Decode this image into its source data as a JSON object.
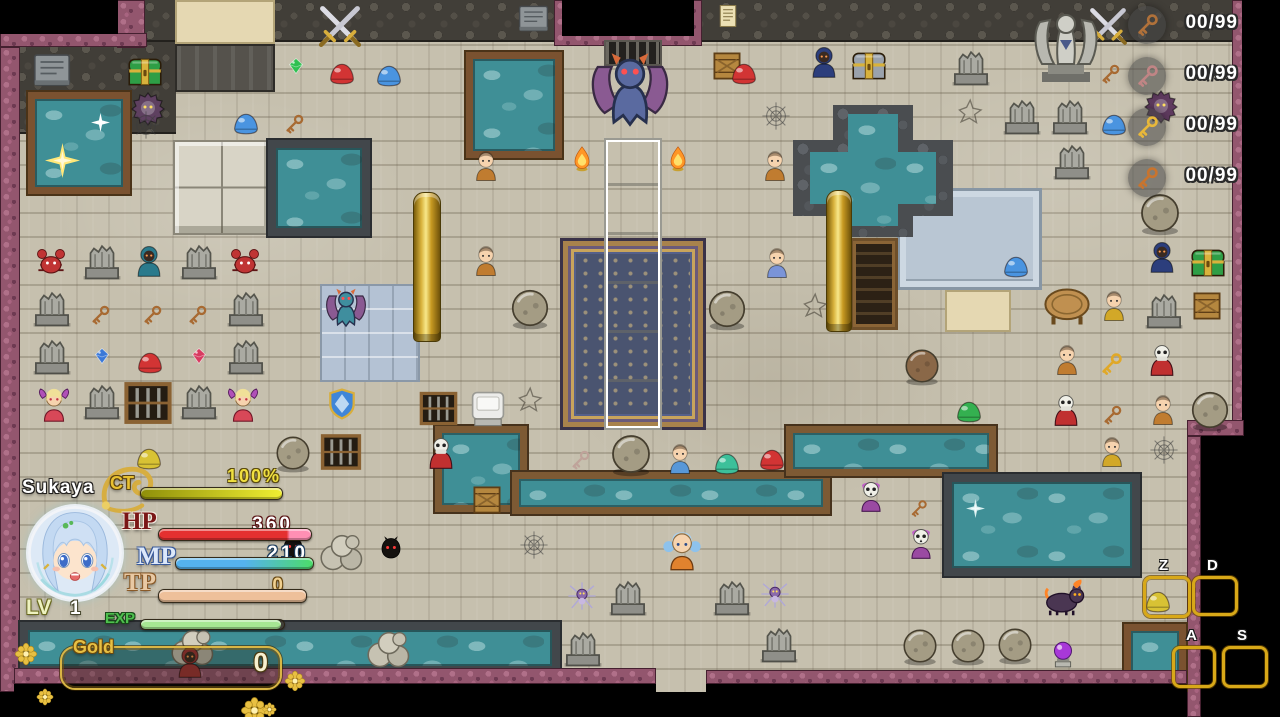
{
  "hud": {
    "name": "Sukaya",
    "ct": {
      "label": "CT",
      "value": "100%",
      "pct": 100,
      "bar_colors": [
        "#8f8f0a",
        "#f0ee32"
      ]
    },
    "hp": {
      "label": "HP",
      "value": "360",
      "pct": 100,
      "bar_color": "#e43030",
      "tip_color": "#ff8fb4"
    },
    "mp": {
      "label": "MP",
      "value": "210",
      "pct": 100,
      "bar_colors": [
        "#55b2ee",
        "#55b2ee",
        "#4cdc6a"
      ]
    },
    "tp": {
      "label": "TP",
      "value": "0",
      "pct": 100,
      "bar_color": "#eec09a"
    },
    "lv": {
      "label": "LV",
      "value": "1"
    },
    "exp": {
      "label": "EXP",
      "pct": 98,
      "bar_color": "#a6e693"
    },
    "gold": {
      "label": "Gold",
      "value": "0"
    },
    "accent_gold": "#d9b544",
    "decor_flowers": [
      {
        "x": 14,
        "y": 642,
        "s": 1.1
      },
      {
        "x": 36,
        "y": 688,
        "s": 0.8
      },
      {
        "x": 284,
        "y": 670,
        "s": 1.0
      },
      {
        "x": 240,
        "y": 696,
        "s": 1.3
      },
      {
        "x": 262,
        "y": 702,
        "s": 0.7
      }
    ]
  },
  "key_counters": [
    {
      "name": "bronze-key",
      "count": "00/99",
      "color": "#b0713a"
    },
    {
      "name": "rose-key",
      "count": "00/99",
      "color": "#c08585"
    },
    {
      "name": "gold-key",
      "count": "00/99",
      "color": "#e8b83a"
    },
    {
      "name": "ornate-key",
      "count": "00/99",
      "color": "#c8742e"
    }
  ],
  "hotkeys": [
    {
      "label": "Z",
      "x": 1143,
      "y": 576,
      "w": 42,
      "h": 36
    },
    {
      "label": "D",
      "x": 1192,
      "y": 576,
      "w": 40,
      "h": 34
    },
    {
      "label": "A",
      "x": 1172,
      "y": 646,
      "w": 38,
      "h": 36
    },
    {
      "label": "S",
      "x": 1222,
      "y": 646,
      "w": 40,
      "h": 36
    }
  ],
  "scene": {
    "regions": [
      {
        "t": "cobble",
        "x": 14,
        "y": 0,
        "w": 1220,
        "h": 42
      },
      {
        "t": "cobble",
        "x": 14,
        "y": 42,
        "w": 162,
        "h": 92
      },
      {
        "t": "tan",
        "x": 175,
        "y": 0,
        "w": 100,
        "h": 44
      },
      {
        "t": "plat",
        "x": 175,
        "y": 44,
        "w": 100,
        "h": 48
      },
      {
        "t": "purple",
        "x": 117,
        "y": 0,
        "w": 28,
        "h": 48
      },
      {
        "t": "purple",
        "x": 0,
        "y": 33,
        "w": 147,
        "h": 14
      },
      {
        "t": "void",
        "x": 0,
        "y": 0,
        "w": 118,
        "h": 34
      },
      {
        "t": "purple",
        "x": 0,
        "y": 47,
        "w": 20,
        "h": 645
      },
      {
        "t": "purple",
        "x": 554,
        "y": 0,
        "w": 148,
        "h": 46
      },
      {
        "t": "void",
        "x": 562,
        "y": 0,
        "w": 132,
        "h": 36
      },
      {
        "t": "vent",
        "x": 604,
        "y": 40,
        "w": 58,
        "h": 26
      },
      {
        "t": "purple",
        "x": 1232,
        "y": 0,
        "w": 12,
        "h": 434
      },
      {
        "t": "void",
        "x": 1242,
        "y": 0,
        "w": 38,
        "h": 717
      },
      {
        "t": "purple",
        "x": 1187,
        "y": 420,
        "w": 57,
        "h": 16
      },
      {
        "t": "purple",
        "x": 1187,
        "y": 436,
        "w": 14,
        "h": 281
      },
      {
        "t": "void",
        "x": 1201,
        "y": 436,
        "w": 41,
        "h": 281
      },
      {
        "t": "tiles",
        "x": 320,
        "y": 284,
        "w": 100,
        "h": 98
      },
      {
        "t": "blocks",
        "x": 173,
        "y": 140,
        "w": 98,
        "h": 95
      },
      {
        "t": "plat2",
        "x": 897,
        "y": 188,
        "w": 145,
        "h": 102
      },
      {
        "t": "tan",
        "x": 945,
        "y": 290,
        "w": 66,
        "h": 42
      },
      {
        "t": "cab",
        "x": 850,
        "y": 238,
        "w": 48,
        "h": 92
      },
      {
        "t": "poolframe",
        "x": 28,
        "y": 92,
        "w": 102,
        "h": 102
      },
      {
        "t": "pooldark",
        "x": 268,
        "y": 140,
        "w": 102,
        "h": 96
      },
      {
        "t": "poolframe",
        "x": 466,
        "y": 52,
        "w": 96,
        "h": 106
      },
      {
        "t": "rocks",
        "x": 833,
        "y": 105,
        "w": 80,
        "h": 132
      },
      {
        "t": "rocks",
        "x": 793,
        "y": 140,
        "w": 160,
        "h": 76
      },
      {
        "t": "water",
        "x": 848,
        "y": 114,
        "w": 50,
        "h": 112
      },
      {
        "t": "water",
        "x": 810,
        "y": 152,
        "w": 126,
        "h": 52
      },
      {
        "t": "pooldark",
        "x": 20,
        "y": 622,
        "w": 540,
        "h": 52
      },
      {
        "t": "canal",
        "x": 435,
        "y": 426,
        "w": 92,
        "h": 86
      },
      {
        "t": "canal",
        "x": 512,
        "y": 472,
        "w": 318,
        "h": 42
      },
      {
        "t": "canal",
        "x": 786,
        "y": 426,
        "w": 210,
        "h": 50
      },
      {
        "t": "pooldark",
        "x": 944,
        "y": 474,
        "w": 196,
        "h": 102
      },
      {
        "t": "poolframe",
        "x": 1124,
        "y": 624,
        "w": 62,
        "h": 66
      },
      {
        "t": "carpet",
        "x": 560,
        "y": 238,
        "w": 146,
        "h": 192
      },
      {
        "t": "altar",
        "x": 604,
        "y": 138,
        "w": 58,
        "h": 292
      },
      {
        "t": "gold",
        "x": 413,
        "y": 192,
        "w": 28,
        "h": 150
      },
      {
        "t": "gold",
        "x": 826,
        "y": 190,
        "w": 26,
        "h": 142
      },
      {
        "t": "purple",
        "x": 14,
        "y": 668,
        "w": 642,
        "h": 16
      },
      {
        "t": "void",
        "x": 14,
        "y": 684,
        "w": 642,
        "h": 33
      },
      {
        "t": "purple",
        "x": 706,
        "y": 670,
        "w": 481,
        "h": 14
      },
      {
        "t": "void",
        "x": 706,
        "y": 684,
        "w": 481,
        "h": 33
      }
    ],
    "entities": [
      {
        "t": "tablet",
        "x": 52,
        "y": 70
      },
      {
        "t": "chest",
        "x": 145,
        "y": 72,
        "c": "#2e9e46"
      },
      {
        "t": "beast",
        "x": 148,
        "y": 108,
        "c": "#5e4060"
      },
      {
        "t": "swords",
        "x": 340,
        "y": 26
      },
      {
        "t": "tablet",
        "x": 533,
        "y": 18,
        "s": 0.8
      },
      {
        "t": "gem",
        "x": 296,
        "y": 66,
        "c": "#2ec050"
      },
      {
        "t": "slime",
        "x": 342,
        "y": 74,
        "c": "#d23434"
      },
      {
        "t": "slime",
        "x": 389,
        "y": 76,
        "c": "#4a94e0"
      },
      {
        "t": "slime",
        "x": 246,
        "y": 124,
        "c": "#4a94e0"
      },
      {
        "t": "key",
        "x": 294,
        "y": 124,
        "c": "#a86a32"
      },
      {
        "t": "notice",
        "x": 728,
        "y": 16
      },
      {
        "t": "crate",
        "x": 727,
        "y": 66
      },
      {
        "t": "slime",
        "x": 744,
        "y": 74,
        "c": "#d23434"
      },
      {
        "t": "hooded",
        "x": 824,
        "y": 62,
        "c": "#2c3e7c"
      },
      {
        "t": "chest",
        "x": 869,
        "y": 66,
        "c": "#9aa2ac"
      },
      {
        "t": "gargoyle",
        "x": 630,
        "y": 90,
        "c": "#5a6aa0",
        "s": 2.1
      },
      {
        "t": "flame",
        "x": 582,
        "y": 158
      },
      {
        "t": "flame",
        "x": 678,
        "y": 158
      },
      {
        "t": "person",
        "x": 486,
        "y": 166,
        "c": "#c07c30"
      },
      {
        "t": "person",
        "x": 775,
        "y": 166,
        "c": "#c07c30"
      },
      {
        "t": "person",
        "x": 486,
        "y": 261,
        "c": "#c07c30"
      },
      {
        "t": "angel",
        "x": 1066,
        "y": 46,
        "s": 1.9
      },
      {
        "t": "swords",
        "x": 1108,
        "y": 26,
        "s": 0.9
      },
      {
        "t": "ruin",
        "x": 971,
        "y": 66
      },
      {
        "t": "ruin",
        "x": 1022,
        "y": 115
      },
      {
        "t": "ruin",
        "x": 1070,
        "y": 115
      },
      {
        "t": "ruin",
        "x": 1072,
        "y": 160
      },
      {
        "t": "key",
        "x": 1110,
        "y": 74,
        "c": "#a86a32"
      },
      {
        "t": "slime",
        "x": 1114,
        "y": 125,
        "c": "#4a94e0"
      },
      {
        "t": "beast",
        "x": 1161,
        "y": 106,
        "c": "#5e3a5e"
      },
      {
        "t": "boulder",
        "x": 1160,
        "y": 213,
        "s": 1.15
      },
      {
        "t": "crack",
        "x": 972,
        "y": 110
      },
      {
        "t": "web",
        "x": 776,
        "y": 116
      },
      {
        "t": "web",
        "x": 146,
        "y": 125
      },
      {
        "t": "crab",
        "x": 51,
        "y": 263,
        "c": "#c03434"
      },
      {
        "t": "hooded",
        "x": 149,
        "y": 261,
        "c": "#2a7a8c"
      },
      {
        "t": "crab",
        "x": 245,
        "y": 263,
        "c": "#c03434"
      },
      {
        "t": "ruin",
        "x": 102,
        "y": 260
      },
      {
        "t": "ruin",
        "x": 199,
        "y": 260
      },
      {
        "t": "ruin",
        "x": 52,
        "y": 307
      },
      {
        "t": "ruin",
        "x": 246,
        "y": 307
      },
      {
        "t": "ruin",
        "x": 52,
        "y": 355
      },
      {
        "t": "ruin",
        "x": 246,
        "y": 355
      },
      {
        "t": "ruin",
        "x": 102,
        "y": 400
      },
      {
        "t": "ruin",
        "x": 199,
        "y": 400
      },
      {
        "t": "key",
        "x": 100,
        "y": 315,
        "c": "#a86a32"
      },
      {
        "t": "key",
        "x": 152,
        "y": 315,
        "c": "#a86a32"
      },
      {
        "t": "key",
        "x": 197,
        "y": 315,
        "c": "#a86a32"
      },
      {
        "t": "gem",
        "x": 102,
        "y": 356,
        "c": "#3a78d8"
      },
      {
        "t": "slime",
        "x": 150,
        "y": 363,
        "c": "#d23434"
      },
      {
        "t": "gem",
        "x": 199,
        "y": 356,
        "c": "#d83a60"
      },
      {
        "t": "succubus",
        "x": 54,
        "y": 406
      },
      {
        "t": "succubus",
        "x": 243,
        "y": 406
      },
      {
        "t": "gate",
        "x": 148,
        "y": 403
      },
      {
        "t": "slime",
        "x": 149,
        "y": 459,
        "c": "#d8c234"
      },
      {
        "t": "gargoyle",
        "x": 346,
        "y": 308,
        "c": "#3f8e9e",
        "s": 1.1
      },
      {
        "t": "shield",
        "x": 342,
        "y": 404
      },
      {
        "t": "gate",
        "x": 341,
        "y": 452,
        "s": 0.85
      },
      {
        "t": "boulder",
        "x": 293,
        "y": 453
      },
      {
        "t": "gate",
        "x": 438,
        "y": 408,
        "s": 0.8
      },
      {
        "t": "capedskull",
        "x": 441,
        "y": 453,
        "c": "#c03030"
      },
      {
        "t": "whitebox",
        "x": 488,
        "y": 408
      },
      {
        "t": "crate",
        "x": 487,
        "y": 500
      },
      {
        "t": "key",
        "x": 580,
        "y": 460,
        "c": "#bfa39a"
      },
      {
        "t": "boulder",
        "x": 631,
        "y": 454,
        "s": 1.15
      },
      {
        "t": "crack",
        "x": 532,
        "y": 398
      },
      {
        "t": "person",
        "x": 777,
        "y": 263,
        "c": "#7a94d8"
      },
      {
        "t": "boulder",
        "x": 530,
        "y": 308,
        "s": 1.1
      },
      {
        "t": "boulder",
        "x": 727,
        "y": 309,
        "s": 1.1
      },
      {
        "t": "person",
        "x": 680,
        "y": 459,
        "c": "#5898d8"
      },
      {
        "t": "slime",
        "x": 727,
        "y": 464,
        "c": "#3cc09a"
      },
      {
        "t": "slime",
        "x": 772,
        "y": 460,
        "c": "#d23434"
      },
      {
        "t": "boulder",
        "x": 922,
        "y": 366,
        "c": "#8a6848"
      },
      {
        "t": "slime",
        "x": 969,
        "y": 412,
        "c": "#34b050"
      },
      {
        "t": "capedskull",
        "x": 1066,
        "y": 410,
        "c": "#c03030"
      },
      {
        "t": "key",
        "x": 1112,
        "y": 415,
        "c": "#a86a32"
      },
      {
        "t": "person",
        "x": 1163,
        "y": 410,
        "c": "#c07c30"
      },
      {
        "t": "boulder",
        "x": 1210,
        "y": 410,
        "s": 1.1
      },
      {
        "t": "slime",
        "x": 1016,
        "y": 267,
        "c": "#4a94e0"
      },
      {
        "t": "table",
        "x": 1067,
        "y": 307
      },
      {
        "t": "person",
        "x": 1114,
        "y": 306,
        "c": "#d2a828"
      },
      {
        "t": "ruin",
        "x": 1164,
        "y": 309
      },
      {
        "t": "crate",
        "x": 1207,
        "y": 306
      },
      {
        "t": "hooded",
        "x": 1162,
        "y": 257,
        "c": "#2c3e7c"
      },
      {
        "t": "chest",
        "x": 1208,
        "y": 263,
        "c": "#2e9e46"
      },
      {
        "t": "person",
        "x": 1067,
        "y": 360,
        "c": "#c07c30"
      },
      {
        "t": "capedskull",
        "x": 1162,
        "y": 360,
        "c": "#c03030"
      },
      {
        "t": "key",
        "x": 1111,
        "y": 364,
        "c": "#e0a828",
        "s": 1.15
      },
      {
        "t": "person",
        "x": 1112,
        "y": 452,
        "c": "#d2a828"
      },
      {
        "t": "crack",
        "x": 817,
        "y": 304
      },
      {
        "t": "web",
        "x": 1164,
        "y": 450
      },
      {
        "t": "skullgirl",
        "x": 871,
        "y": 496
      },
      {
        "t": "skullgirl",
        "x": 921,
        "y": 543
      },
      {
        "t": "key",
        "x": 918,
        "y": 508,
        "c": "#a86a32",
        "s": 0.9
      },
      {
        "t": "player",
        "x": 682,
        "y": 551
      },
      {
        "t": "imp",
        "x": 293,
        "y": 548
      },
      {
        "t": "imp",
        "x": 391,
        "y": 549
      },
      {
        "t": "rockpile",
        "x": 342,
        "y": 550
      },
      {
        "t": "rockpile",
        "x": 389,
        "y": 647
      },
      {
        "t": "rockpile",
        "x": 193,
        "y": 645
      },
      {
        "t": "hooded",
        "x": 190,
        "y": 662,
        "c": "#a03434"
      },
      {
        "t": "spider",
        "x": 582,
        "y": 596
      },
      {
        "t": "spider",
        "x": 775,
        "y": 594
      },
      {
        "t": "ruin",
        "x": 628,
        "y": 596
      },
      {
        "t": "ruin",
        "x": 732,
        "y": 596
      },
      {
        "t": "ruin",
        "x": 779,
        "y": 643
      },
      {
        "t": "ruin",
        "x": 583,
        "y": 647
      },
      {
        "t": "boulder",
        "x": 920,
        "y": 646
      },
      {
        "t": "boulder",
        "x": 968,
        "y": 646
      },
      {
        "t": "boulder",
        "x": 1015,
        "y": 645
      },
      {
        "t": "orb",
        "x": 1063,
        "y": 655
      },
      {
        "t": "cat",
        "x": 1064,
        "y": 598,
        "c": "#4a3652"
      },
      {
        "t": "slime",
        "x": 1158,
        "y": 602,
        "c": "#d8c234"
      },
      {
        "t": "web",
        "x": 534,
        "y": 545
      },
      {
        "t": "sparkle",
        "x": 62,
        "y": 160,
        "c": "#ffe87a",
        "s": 1.5
      },
      {
        "t": "sparkle",
        "x": 100,
        "y": 122,
        "c": "#ffffff",
        "s": 0.8
      },
      {
        "t": "sparkle",
        "x": 975,
        "y": 508,
        "c": "#d8f0f0",
        "s": 0.8
      }
    ]
  }
}
